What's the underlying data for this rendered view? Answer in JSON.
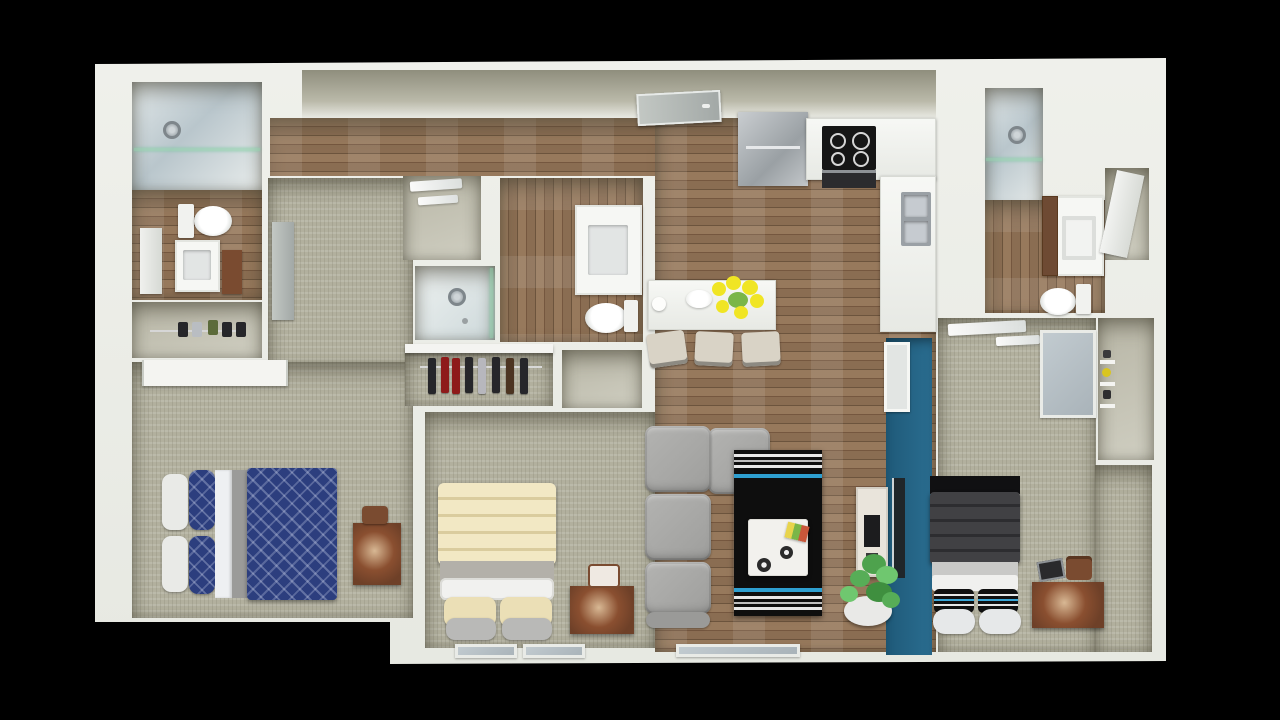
{
  "scene": {
    "type": "3d-floor-plan-render",
    "view": "top-down dollhouse",
    "background": "#000000"
  },
  "palette": {
    "bg": "#000000",
    "plan": "#eceee8",
    "innerWall": "#a3a293",
    "carpet": "#b2b09e",
    "wood": "#8a6d52",
    "woodLight": "#97795c",
    "woodDark": "#75573f",
    "tile": "#cfd8d9",
    "teal": "#24617f",
    "navy": "#2c3e7e",
    "cream": "#efe5bd",
    "darkBlanket": "#3a3a3d",
    "sofa": "#a9a9a7",
    "rug": "#0e0e0e",
    "rugBlue": "#2e9fd0",
    "desk": "#6e4028",
    "plant": "#5cb85c",
    "flower": "#f0e524",
    "steel": "#b9bdc2",
    "door": "#9fa6a8"
  },
  "rooms": [
    {
      "id": "bathroom-left",
      "label": "Bathroom 1",
      "floor": "wood + tile shower"
    },
    {
      "id": "closet-left",
      "label": "Closet (shoes shelf)",
      "floor": "carpet"
    },
    {
      "id": "bedroom-left",
      "label": "Bedroom 1 (navy bedding)",
      "floor": "carpet"
    },
    {
      "id": "entry-closet",
      "label": "Utility / linen room",
      "floor": "plain"
    },
    {
      "id": "shower-room",
      "label": "Shower room",
      "floor": "tile"
    },
    {
      "id": "bathroom-center",
      "label": "Bathroom 2",
      "floor": "wood"
    },
    {
      "id": "closet-center",
      "label": "Closet (hanging clothes)",
      "floor": "carpet"
    },
    {
      "id": "bedroom-middle",
      "label": "Bedroom 2 (cream bedding)",
      "floor": "carpet"
    },
    {
      "id": "hallway",
      "label": "Entry hallway",
      "floor": "wood"
    },
    {
      "id": "kitchen",
      "label": "Kitchen",
      "floor": "wood"
    },
    {
      "id": "dining-area",
      "label": "Dining bar",
      "floor": "wood"
    },
    {
      "id": "living-room",
      "label": "Living room",
      "floor": "wood"
    },
    {
      "id": "bedroom-right",
      "label": "Bedroom 3 (dark bedding)",
      "floor": "carpet"
    },
    {
      "id": "closet-right",
      "label": "Closet (wall shelves)",
      "floor": "plain"
    },
    {
      "id": "bathroom-right",
      "label": "Bathroom 3",
      "floor": "wood + tile shower"
    }
  ],
  "furniture": {
    "bathroom-left": [
      "walk-in shower with glass",
      "toilet",
      "vanity sink",
      "door",
      "brown cabinet"
    ],
    "closet-left": [
      "shelf rod",
      "shoes"
    ],
    "bedroom-left": [
      "bed with navy patterned comforter",
      "white pillows",
      "navy pillows",
      "desk",
      "desk chair",
      "sliding closet doors",
      "room door"
    ],
    "bathroom-center": [
      "vanity sink",
      "toilet",
      "shower with glass"
    ],
    "closet-center": [
      "hanging clothes (dark and red)"
    ],
    "bedroom-middle": [
      "bed with cream comforter",
      "cream pillows",
      "gray pillows",
      "desk",
      "chair",
      "two windows"
    ],
    "kitchen": [
      "refrigerator",
      "L-shaped counter",
      "stove with four burners",
      "oven",
      "double stainless sink",
      "entry door"
    ],
    "dining-area": [
      "white bar table",
      "yellow flower bouquet",
      "plate",
      "cup",
      "three chairs"
    ],
    "living-room": [
      "gray sectional sofa",
      "black striped rug with blue accent",
      "white coffee table",
      "decor rosettes",
      "book",
      "media console",
      "wall TV panel",
      "teal accent wall",
      "potted plant",
      "patio glass door"
    ],
    "bedroom-right": [
      "bed with dark comforter",
      "striped pillows",
      "white pillows",
      "desk",
      "laptop",
      "bag",
      "window shade",
      "ceiling lights",
      "wall mirror panel"
    ],
    "closet-right": [
      "wall shelves",
      "stored items"
    ],
    "bathroom-right": [
      "walk-in shower",
      "vanity with brown cabinet",
      "toilet",
      "mirror door"
    ]
  }
}
